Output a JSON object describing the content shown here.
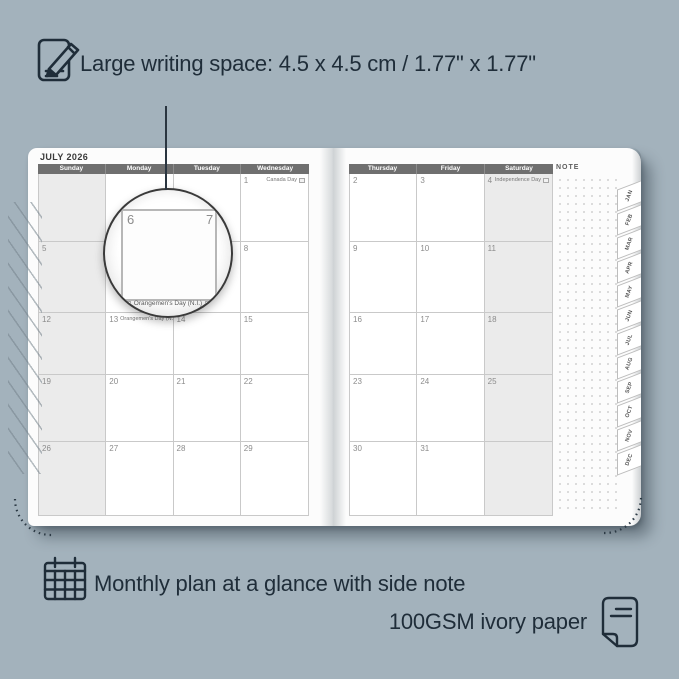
{
  "colors": {
    "background": "#a3b2bc",
    "ink": "#1f2d39",
    "header_bg": "#6f6f6f",
    "weekend_shade": "#ebebeb",
    "page": "#fcfcfc"
  },
  "top_annotation": {
    "text": "Large writing space: 4.5 x 4.5 cm / 1.77\" x 1.77\""
  },
  "planner": {
    "title": "JULY 2026",
    "note_label": "NOTE",
    "tabs": [
      "JAN",
      "FEB",
      "MAR",
      "APR",
      "MAY",
      "JUN",
      "JUL",
      "AUG",
      "SEP",
      "OCT",
      "NOV",
      "DEC"
    ],
    "left_page": {
      "columns": [
        "Sunday",
        "Monday",
        "Tuesday",
        "Wednesday"
      ],
      "shaded_column": 0,
      "rows": [
        [
          {
            "day": ""
          },
          {
            "day": ""
          },
          {
            "day": ""
          },
          {
            "day": "1",
            "holiday": "Canada Day",
            "flag": true
          }
        ],
        [
          {
            "day": "5"
          },
          {
            "day": "6"
          },
          {
            "day": "7"
          },
          {
            "day": "8"
          }
        ],
        [
          {
            "day": "12"
          },
          {
            "day": "13",
            "holiday": "Orangemen's Day (N.I.)",
            "flag": true,
            "inline": true
          },
          {
            "day": "14"
          },
          {
            "day": "15"
          }
        ],
        [
          {
            "day": "19"
          },
          {
            "day": "20"
          },
          {
            "day": "21"
          },
          {
            "day": "22"
          }
        ],
        [
          {
            "day": "26"
          },
          {
            "day": "27"
          },
          {
            "day": "28"
          },
          {
            "day": "29"
          }
        ]
      ]
    },
    "right_page": {
      "columns": [
        "Thursday",
        "Friday",
        "Saturday"
      ],
      "shaded_column": 2,
      "rows": [
        [
          {
            "day": "2"
          },
          {
            "day": "3"
          },
          {
            "day": "4",
            "holiday": "Independence Day",
            "flag": true
          }
        ],
        [
          {
            "day": "9"
          },
          {
            "day": "10"
          },
          {
            "day": "11"
          }
        ],
        [
          {
            "day": "16"
          },
          {
            "day": "17"
          },
          {
            "day": "18"
          }
        ],
        [
          {
            "day": "23"
          },
          {
            "day": "24"
          },
          {
            "day": "25"
          }
        ],
        [
          {
            "day": "30"
          },
          {
            "day": "31"
          },
          {
            "day": ""
          }
        ]
      ]
    }
  },
  "magnifier": {
    "left_day": "6",
    "right_day": "7",
    "holiday": "Orangemen's Day (N.I.)"
  },
  "bottom_annotations": {
    "line1": "Monthly plan at a glance with side note",
    "line2": "100GSM ivory paper"
  }
}
